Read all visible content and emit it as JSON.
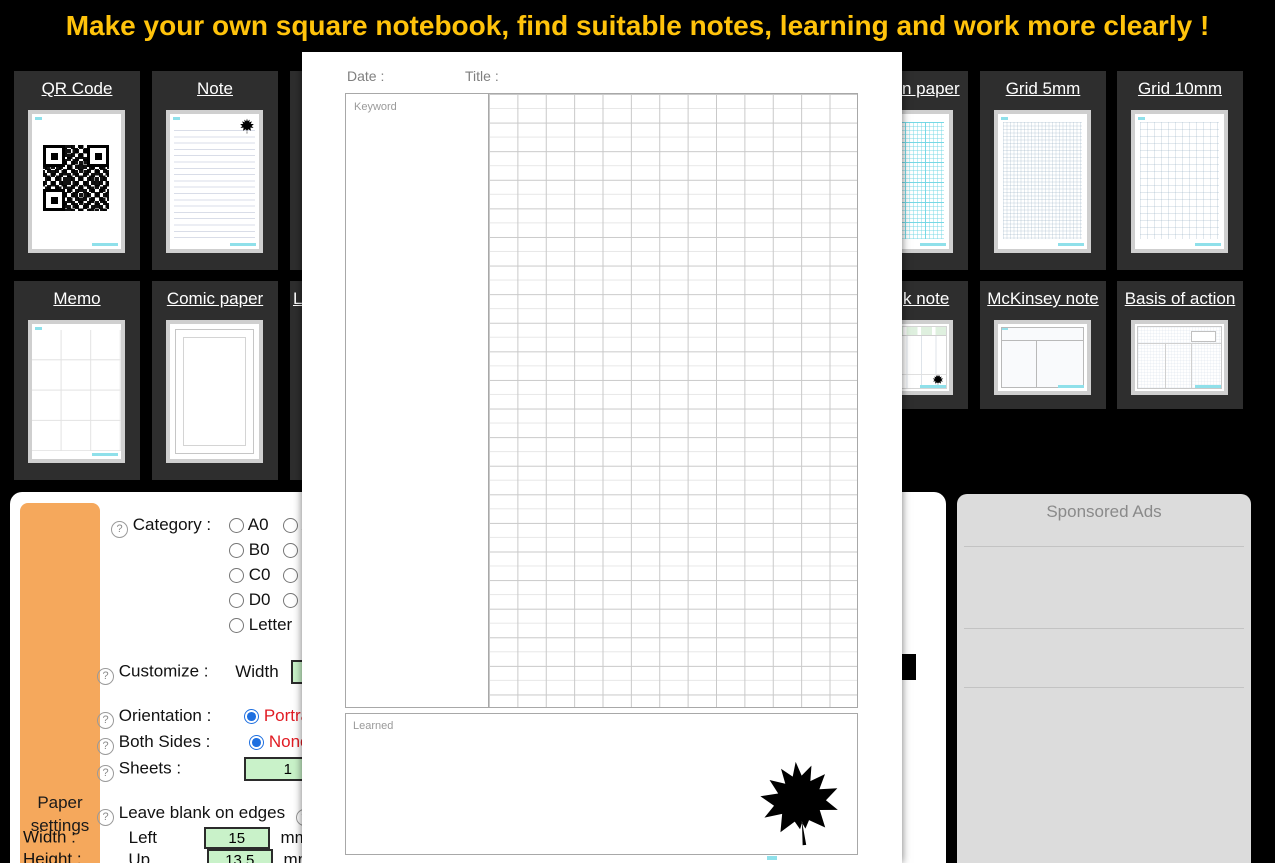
{
  "banner": {
    "title": "Make your own square notebook, find suitable notes, learning and work more clearly !"
  },
  "cards": {
    "row1": [
      {
        "label": "QR Code"
      },
      {
        "label": "Note"
      },
      {
        "label": ""
      },
      {
        "label": "n paper"
      },
      {
        "label": "Grid 5mm"
      },
      {
        "label": "Grid 10mm"
      }
    ],
    "row2": [
      {
        "label": "Memo"
      },
      {
        "label": "Comic paper"
      },
      {
        "label": "L"
      },
      {
        "label": "k note"
      },
      {
        "label": "McKinsey note"
      },
      {
        "label": "Basis of action"
      }
    ]
  },
  "preview_modal": {
    "date_label": "Date :",
    "title_label": "Title :",
    "keyword_label": "Keyword",
    "learned_label": "Learned"
  },
  "paper_settings": {
    "tab_line1": "Paper",
    "tab_line2": "settings",
    "category": {
      "label": "Category :",
      "col1": [
        "A0",
        "B0",
        "C0",
        "D0",
        "Letter"
      ],
      "col2": [
        "A1",
        "B1",
        "C1",
        "D1"
      ]
    },
    "customize": {
      "label": "Customize :",
      "width_label": "Width"
    },
    "orientation": {
      "label": "Orientation :",
      "value": "Portrait"
    },
    "both_sides": {
      "label": "Both Sides :",
      "value": "None"
    },
    "sheets": {
      "label": "Sheets :",
      "value": "1"
    },
    "blank_edges": {
      "label": "Leave blank on edges"
    },
    "width_row": {
      "label": "Width :",
      "side": "Left",
      "value": "15",
      "unit": "mm"
    },
    "height_row": {
      "label": "Height :",
      "side": "Up",
      "value": "13.5",
      "unit": "mm"
    }
  },
  "ads": {
    "title": "Sponsored Ads"
  },
  "colors": {
    "banner_yellow": "#FFC30B",
    "tab_orange": "#F5A85C",
    "input_green": "#C9F2C9",
    "value_red": "#E11B23",
    "radio_blue": "#1E6FE0",
    "watermark_cyan": "#8FE0EA"
  }
}
